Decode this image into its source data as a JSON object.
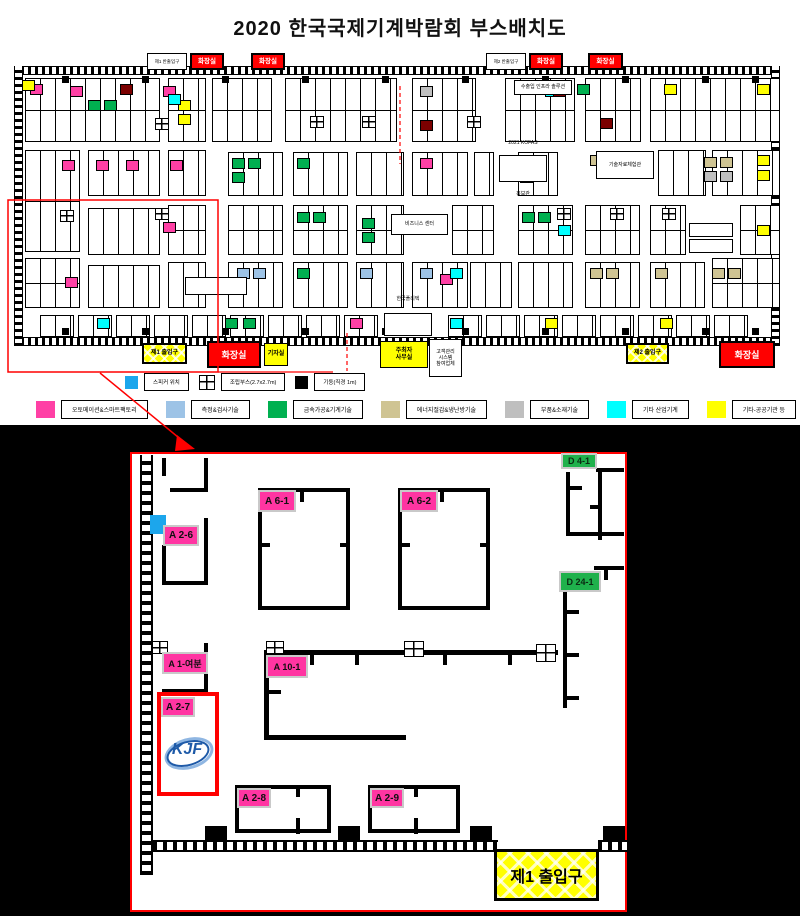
{
  "title": "2020 한국국제기계박람회 부스배치도",
  "colors": {
    "pink": "#FF40A5",
    "green": "#00B050",
    "yellow": "#FFFF00",
    "cyan": "#00FFFF",
    "blue": "#9DC3E6",
    "tan": "#CFC493",
    "gray": "#BFBFBF",
    "darkred": "#7B0000",
    "toilet_red": "#FF0000",
    "speaker_blue": "#1CA6EC",
    "highlight_red": "#FF0000",
    "logo_blue": "#1E5AA8"
  },
  "overview": {
    "top_boxes": [
      {
        "lines": [
          "제1 반출입구"
        ],
        "type": "plain",
        "x": 147,
        "y": 53,
        "w": 40,
        "h": 17
      },
      {
        "lines": [
          "화장실"
        ],
        "type": "toilet",
        "x": 190,
        "y": 53,
        "w": 34,
        "h": 17
      },
      {
        "lines": [
          "화장실"
        ],
        "type": "toilet",
        "x": 251,
        "y": 53,
        "w": 34,
        "h": 17
      },
      {
        "lines": [
          "제2 반출입구"
        ],
        "type": "plain",
        "x": 486,
        "y": 53,
        "w": 40,
        "h": 17
      },
      {
        "lines": [
          "화장실"
        ],
        "type": "toilet",
        "x": 529,
        "y": 53,
        "w": 34,
        "h": 17
      },
      {
        "lines": [
          "화장실"
        ],
        "type": "toilet",
        "x": 588,
        "y": 53,
        "w": 35,
        "h": 17
      }
    ],
    "bottom_boxes": [
      {
        "lines": [
          "제1 출입구"
        ],
        "type": "gate",
        "x": 142,
        "y": 343,
        "w": 45,
        "h": 21
      },
      {
        "lines": [
          "화장실"
        ],
        "type": "toilet-big",
        "x": 207,
        "y": 341,
        "w": 54,
        "h": 27
      },
      {
        "lines": [
          "기자실"
        ],
        "type": "yellow",
        "x": 264,
        "y": 343,
        "w": 24,
        "h": 23
      },
      {
        "lines": [
          "주최자",
          "사무실"
        ],
        "type": "yellow",
        "x": 380,
        "y": 341,
        "w": 48,
        "h": 27
      },
      {
        "lines": [
          "고객관리",
          "시스템",
          "참여업체"
        ],
        "type": "plain",
        "x": 429,
        "y": 339,
        "w": 33,
        "h": 38
      },
      {
        "lines": [
          "제2 출입구"
        ],
        "type": "gate",
        "x": 626,
        "y": 343,
        "w": 43,
        "h": 21
      },
      {
        "lines": [
          "화장실"
        ],
        "type": "toilet-big",
        "x": 719,
        "y": 341,
        "w": 56,
        "h": 27
      }
    ],
    "info_boxes": [
      {
        "lines": [
          "수출입 인프라 솔루션"
        ],
        "x": 514,
        "y": 80,
        "w": 58,
        "h": 15
      },
      {
        "lines": [
          "2021 KOFAS",
          "홍보관"
        ],
        "x": 499,
        "y": 155,
        "w": 48,
        "h": 27
      },
      {
        "lines": [
          "기술자료체험관"
        ],
        "x": 596,
        "y": 151,
        "w": 58,
        "h": 28
      },
      {
        "lines": [
          "비즈니스 센터"
        ],
        "x": 391,
        "y": 214,
        "w": 57,
        "h": 21
      },
      {
        "lines": [
          "한국폴리텍",
          "대학"
        ],
        "x": 384,
        "y": 313,
        "w": 48,
        "h": 23
      },
      {
        "lines": [
          ""
        ],
        "x": 185,
        "y": 277,
        "w": 62,
        "h": 18
      },
      {
        "lines": [
          ""
        ],
        "x": 689,
        "y": 223,
        "w": 44,
        "h": 14
      },
      {
        "lines": [
          ""
        ],
        "x": 689,
        "y": 239,
        "w": 44,
        "h": 14
      }
    ],
    "legend_row1": [
      {
        "swatch": "cyan",
        "label": "스피커 위치"
      },
      {
        "swatch": "grid",
        "label": "조립부스(2.7x2.7m)"
      },
      {
        "swatch": "black",
        "label": "기둥(직경 1m)"
      }
    ],
    "legend_row2": [
      {
        "color": "#FF40A5",
        "label": "오토메이션&스마트팩토리"
      },
      {
        "color": "#9DC3E6",
        "label": "측정&검사기술"
      },
      {
        "color": "#00B050",
        "label": "금속가공&기계기술"
      },
      {
        "color": "#CFC493",
        "label": "에너지절감&냉난방기술"
      },
      {
        "color": "#BFBFBF",
        "label": "부품&소재기술"
      },
      {
        "color": "#00FFFF",
        "label": "기타 산업기계"
      },
      {
        "color": "#FFFF00",
        "label": "기타-공공기관 등"
      }
    ],
    "blocks": [
      [
        25,
        78,
        135,
        64
      ],
      [
        168,
        78,
        38,
        64
      ],
      [
        212,
        78,
        60,
        64
      ],
      [
        285,
        78,
        112,
        64
      ],
      [
        412,
        78,
        64,
        64
      ],
      [
        505,
        78,
        70,
        64
      ],
      [
        585,
        78,
        56,
        64
      ],
      [
        650,
        78,
        130,
        64
      ],
      [
        25,
        150,
        55,
        102
      ],
      [
        88,
        150,
        72,
        46
      ],
      [
        168,
        150,
        38,
        46
      ],
      [
        228,
        152,
        55,
        44
      ],
      [
        293,
        152,
        55,
        44
      ],
      [
        356,
        152,
        48,
        44
      ],
      [
        412,
        152,
        56,
        44
      ],
      [
        474,
        152,
        20,
        44
      ],
      [
        518,
        152,
        40,
        44
      ],
      [
        658,
        150,
        48,
        46
      ],
      [
        712,
        150,
        68,
        46
      ],
      [
        88,
        208,
        72,
        47
      ],
      [
        168,
        205,
        38,
        50
      ],
      [
        228,
        205,
        55,
        50
      ],
      [
        293,
        205,
        55,
        50
      ],
      [
        356,
        205,
        48,
        50
      ],
      [
        452,
        205,
        42,
        50
      ],
      [
        518,
        205,
        55,
        50
      ],
      [
        585,
        205,
        55,
        50
      ],
      [
        650,
        205,
        36,
        50
      ],
      [
        740,
        205,
        40,
        50
      ],
      [
        25,
        258,
        55,
        50
      ],
      [
        88,
        265,
        72,
        43
      ],
      [
        168,
        262,
        38,
        46
      ],
      [
        228,
        262,
        55,
        46
      ],
      [
        293,
        262,
        55,
        46
      ],
      [
        356,
        262,
        48,
        46
      ],
      [
        412,
        262,
        56,
        46
      ],
      [
        470,
        262,
        42,
        46
      ],
      [
        518,
        262,
        55,
        46
      ],
      [
        585,
        262,
        55,
        46
      ],
      [
        650,
        262,
        55,
        46
      ],
      [
        712,
        258,
        68,
        50
      ]
    ],
    "strip_y": 315,
    "strip_xs": [
      40,
      78,
      116,
      154,
      192,
      230,
      268,
      306,
      344,
      448,
      486,
      524,
      562,
      600,
      638,
      676,
      714
    ],
    "cells": [
      [
        30,
        84,
        "pink"
      ],
      [
        70,
        86,
        "pink"
      ],
      [
        163,
        86,
        "pink"
      ],
      [
        62,
        160,
        "pink"
      ],
      [
        96,
        160,
        "pink"
      ],
      [
        126,
        160,
        "pink"
      ],
      [
        170,
        160,
        "pink"
      ],
      [
        420,
        158,
        "pink"
      ],
      [
        520,
        158,
        "pink"
      ],
      [
        520,
        172,
        "pink"
      ],
      [
        65,
        277,
        "pink"
      ],
      [
        440,
        274,
        "pink"
      ],
      [
        350,
        318,
        "pink"
      ],
      [
        163,
        222,
        "pink"
      ],
      [
        88,
        100,
        "green"
      ],
      [
        104,
        100,
        "green"
      ],
      [
        232,
        158,
        "green"
      ],
      [
        248,
        158,
        "green"
      ],
      [
        232,
        172,
        "green"
      ],
      [
        297,
        158,
        "green"
      ],
      [
        297,
        212,
        "green"
      ],
      [
        313,
        212,
        "green"
      ],
      [
        522,
        212,
        "green"
      ],
      [
        538,
        212,
        "green"
      ],
      [
        297,
        268,
        "green"
      ],
      [
        362,
        218,
        "green"
      ],
      [
        362,
        232,
        "green"
      ],
      [
        225,
        318,
        "green"
      ],
      [
        243,
        318,
        "green"
      ],
      [
        577,
        84,
        "green"
      ],
      [
        22,
        80,
        "yellow"
      ],
      [
        178,
        100,
        "yellow"
      ],
      [
        178,
        114,
        "yellow"
      ],
      [
        757,
        155,
        "yellow"
      ],
      [
        757,
        170,
        "yellow"
      ],
      [
        757,
        84,
        "yellow"
      ],
      [
        664,
        84,
        "yellow"
      ],
      [
        660,
        318,
        "yellow"
      ],
      [
        757,
        225,
        "yellow"
      ],
      [
        545,
        318,
        "yellow"
      ],
      [
        168,
        94,
        "cyan"
      ],
      [
        450,
        268,
        "cyan"
      ],
      [
        545,
        86,
        "cyan"
      ],
      [
        558,
        225,
        "cyan"
      ],
      [
        450,
        318,
        "cyan"
      ],
      [
        97,
        318,
        "cyan"
      ],
      [
        237,
        268,
        "blue"
      ],
      [
        253,
        268,
        "blue"
      ],
      [
        360,
        268,
        "blue"
      ],
      [
        420,
        268,
        "blue"
      ],
      [
        590,
        268,
        "tan"
      ],
      [
        606,
        268,
        "tan"
      ],
      [
        655,
        268,
        "tan"
      ],
      [
        712,
        268,
        "tan"
      ],
      [
        728,
        268,
        "tan"
      ],
      [
        704,
        157,
        "tan"
      ],
      [
        720,
        157,
        "tan"
      ],
      [
        590,
        155,
        "tan"
      ],
      [
        704,
        171,
        "gray"
      ],
      [
        720,
        171,
        "gray"
      ],
      [
        420,
        86,
        "gray"
      ],
      [
        120,
        84,
        "darkred"
      ],
      [
        553,
        86,
        "darkred"
      ],
      [
        600,
        118,
        "darkred"
      ],
      [
        420,
        120,
        "darkred"
      ]
    ],
    "grid_icons": [
      [
        155,
        118
      ],
      [
        310,
        116
      ],
      [
        362,
        116
      ],
      [
        467,
        116
      ],
      [
        60,
        210
      ],
      [
        155,
        208
      ],
      [
        557,
        208
      ],
      [
        610,
        208
      ],
      [
        662,
        208
      ]
    ],
    "pillar_xs": [
      62,
      142,
      222,
      302,
      382,
      462,
      542,
      622,
      702,
      752
    ]
  },
  "detail": {
    "labels": [
      {
        "text": "A 6-1",
        "color": "pink",
        "x": 258,
        "y": 490,
        "w": 38,
        "h": 22
      },
      {
        "text": "A 6-2",
        "color": "pink",
        "x": 400,
        "y": 490,
        "w": 38,
        "h": 22
      },
      {
        "text": "D 4-1",
        "color": "green",
        "x": 561,
        "y": 453,
        "w": 36,
        "h": 16
      },
      {
        "text": "A 2-6",
        "color": "pink",
        "x": 163,
        "y": 525,
        "w": 36,
        "h": 21
      },
      {
        "text": "D 24-1",
        "color": "green",
        "x": 559,
        "y": 571,
        "w": 42,
        "h": 21
      },
      {
        "text": "A 1-여분",
        "color": "pink",
        "x": 162,
        "y": 652,
        "w": 46,
        "h": 22
      },
      {
        "text": "A 10-1",
        "color": "pink",
        "x": 266,
        "y": 655,
        "w": 42,
        "h": 23
      },
      {
        "text": "A 2-7",
        "color": "pink",
        "x": 161,
        "y": 697,
        "w": 34,
        "h": 20
      },
      {
        "text": "A 2-8",
        "color": "pink",
        "x": 237,
        "y": 788,
        "w": 34,
        "h": 20
      },
      {
        "text": "A 2-9",
        "color": "pink",
        "x": 370,
        "y": 788,
        "w": 34,
        "h": 20
      }
    ],
    "logo_text": "KJF",
    "entrance_label": "제1 출입구",
    "booths": [
      [
        258,
        488,
        92,
        122
      ],
      [
        398,
        488,
        92,
        122
      ],
      [
        235,
        785,
        96,
        48
      ],
      [
        368,
        785,
        92,
        48
      ]
    ],
    "walls": [
      [
        204,
        458,
        4,
        34
      ],
      [
        170,
        488,
        38,
        4
      ],
      [
        162,
        458,
        4,
        18
      ],
      [
        204,
        518,
        4,
        67
      ],
      [
        162,
        545,
        4,
        40
      ],
      [
        162,
        581,
        46,
        4
      ],
      [
        566,
        472,
        4,
        64
      ],
      [
        570,
        486,
        12,
        4
      ],
      [
        566,
        532,
        58,
        4
      ],
      [
        596,
        468,
        28,
        4
      ],
      [
        594,
        566,
        30,
        4
      ],
      [
        604,
        570,
        4,
        10
      ],
      [
        563,
        588,
        4,
        120
      ],
      [
        567,
        610,
        12,
        4
      ],
      [
        567,
        653,
        12,
        4
      ],
      [
        567,
        696,
        12,
        4
      ],
      [
        264,
        650,
        294,
        5
      ],
      [
        310,
        655,
        4,
        10
      ],
      [
        355,
        655,
        4,
        10
      ],
      [
        443,
        655,
        4,
        10
      ],
      [
        508,
        655,
        4,
        10
      ],
      [
        264,
        655,
        5,
        85
      ],
      [
        264,
        735,
        142,
        5
      ],
      [
        269,
        690,
        12,
        4
      ],
      [
        204,
        643,
        4,
        50
      ],
      [
        162,
        689,
        46,
        4
      ],
      [
        162,
        643,
        4,
        12
      ],
      [
        598,
        470,
        4,
        70
      ],
      [
        590,
        505,
        12,
        4
      ],
      [
        204,
        688,
        4,
        24
      ],
      [
        300,
        490,
        4,
        12
      ],
      [
        340,
        543,
        10,
        4
      ],
      [
        260,
        543,
        10,
        4
      ],
      [
        440,
        490,
        4,
        12
      ],
      [
        480,
        543,
        10,
        4
      ],
      [
        400,
        543,
        10,
        4
      ],
      [
        296,
        787,
        4,
        10
      ],
      [
        296,
        818,
        4,
        16
      ],
      [
        414,
        787,
        4,
        10
      ],
      [
        414,
        818,
        4,
        16
      ]
    ],
    "grid_icons": [
      [
        152,
        641,
        16,
        13
      ],
      [
        266,
        641,
        18,
        13
      ],
      [
        404,
        641,
        20,
        16
      ],
      [
        536,
        644,
        20,
        18
      ]
    ],
    "pillars": [
      [
        205,
        826,
        22,
        16
      ],
      [
        338,
        826,
        22,
        16
      ],
      [
        470,
        826,
        22,
        16
      ],
      [
        603,
        826,
        22,
        16
      ]
    ],
    "hatch_walls": [
      [
        153,
        840,
        345,
        12
      ],
      [
        598,
        840,
        29,
        12
      ]
    ]
  }
}
